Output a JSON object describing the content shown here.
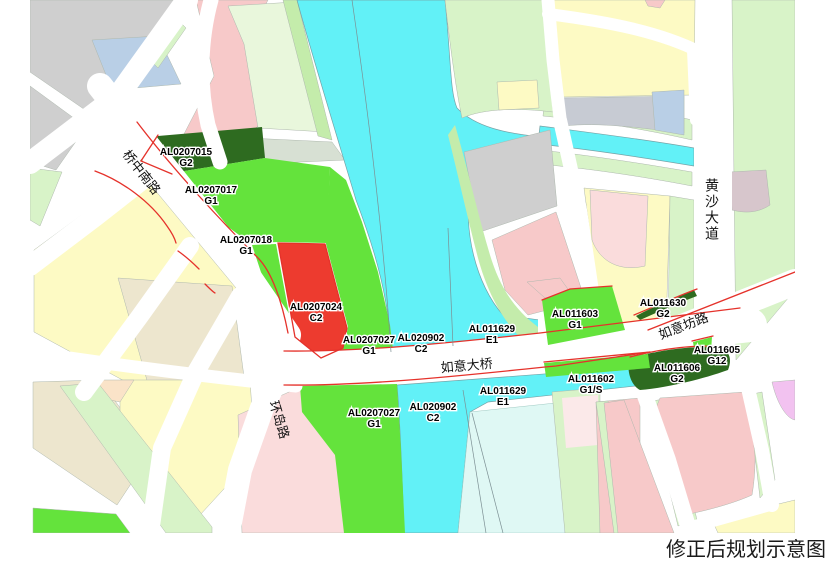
{
  "caption": "修正后规划示意图",
  "roads": {
    "qiaozhongnanlu": "桥中南路",
    "huandaolu": "环岛路",
    "ruyidaqiao": "如意大桥",
    "ruyifanglu": "如意坊路",
    "huangshadadao": "黄沙大道"
  },
  "parcels": [
    {
      "code": "AL0207015",
      "class": "G2"
    },
    {
      "code": "AL0207017",
      "class": "G1"
    },
    {
      "code": "AL0207018",
      "class": "G1"
    },
    {
      "code": "AL0207024",
      "class": "C2"
    },
    {
      "code": "AL0207027",
      "class": "G1"
    },
    {
      "code": "AL020902",
      "class": "C2"
    },
    {
      "code": "AL011629",
      "class": "E1"
    },
    {
      "code": "AL011603",
      "class": "G1"
    },
    {
      "code": "AL011630",
      "class": "G2"
    },
    {
      "code": "AL011605",
      "class": "G12"
    },
    {
      "code": "AL011606",
      "class": "G2"
    },
    {
      "code": "AL011602",
      "class": "G1/S"
    },
    {
      "code": "AL011629",
      "class": "E1"
    },
    {
      "code": "AL020902",
      "class": "C2"
    },
    {
      "code": "AL0207027",
      "class": "G1"
    }
  ],
  "colors": {
    "water": "#62F1F7",
    "pale_water": "#DFF8F4",
    "park_green": "#64E33C",
    "dark_green": "#2E6B20",
    "commercial_red": "#ED3B2F",
    "residential_pink": "#F7C9C9",
    "residential_yellow": "#FDFAC4",
    "open_pale_green": "#D8F3C8",
    "industry_gray": "#CFCFCF",
    "planning_red_line": "#E5322B"
  }
}
